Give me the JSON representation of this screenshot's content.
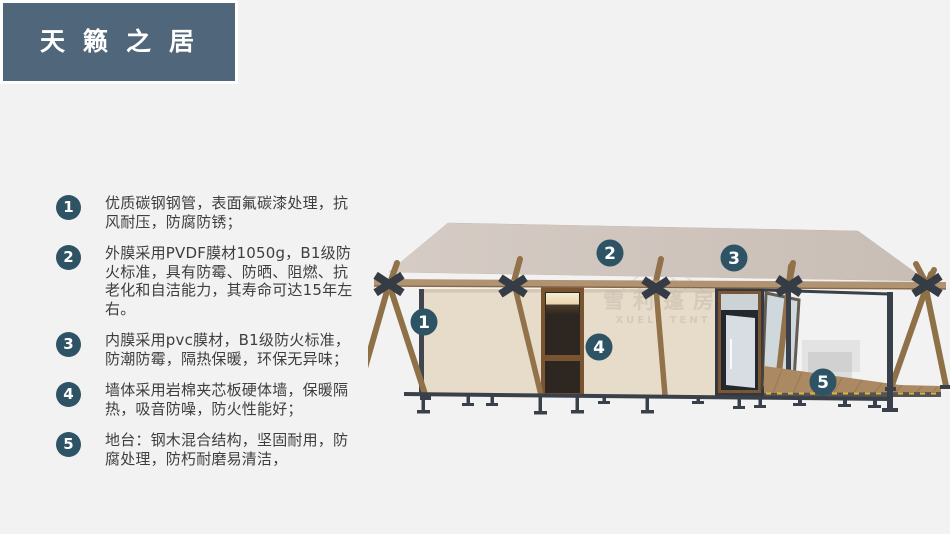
{
  "page": {
    "background": "#f2f2f2"
  },
  "header": {
    "title": "天籁之居",
    "bg_color": "#50667a",
    "text_color": "#ffffff"
  },
  "features": {
    "badge_color": "#2d5365",
    "text_color": "#3e3e3e",
    "items": [
      {
        "num": "1",
        "text": "优质碳钢钢管，表面氟碳漆处理，抗风耐压，防腐防锈；"
      },
      {
        "num": "2",
        "text": "外膜采用PVDF膜材1050g，B1级防火标准，具有防霉、防晒、阻燃、抗老化和自洁能力，其寿命可达15年左右。"
      },
      {
        "num": "3",
        "text": "内膜采用pvc膜材，B1级防火标准，防潮防霉，隔热保暖，环保无异味；"
      },
      {
        "num": "4",
        "text": "墙体采用岩棉夹芯板硬体墙，保暖隔热，吸音防噪，防火性能好；"
      },
      {
        "num": "5",
        "text": "地台：钢木混合结构，坚固耐用，防腐处理，防朽耐磨易清洁，"
      }
    ]
  },
  "diagram": {
    "markers": [
      {
        "label": "1"
      },
      {
        "label": "2"
      },
      {
        "label": "3"
      },
      {
        "label": "4"
      },
      {
        "label": "5"
      }
    ],
    "watermark": {
      "line1": "雪利篷房",
      "line2": "XUELI TENT"
    },
    "colors": {
      "roof": "#cec4bc",
      "wall": "#e6dcc9",
      "wood": "#8f7148",
      "beam": "#b29371",
      "steel": "#3a4047",
      "deck": "#ab8a63",
      "marker": "#2d5365",
      "door_dark": "#2e2620",
      "glass": "#d7dde2"
    }
  }
}
